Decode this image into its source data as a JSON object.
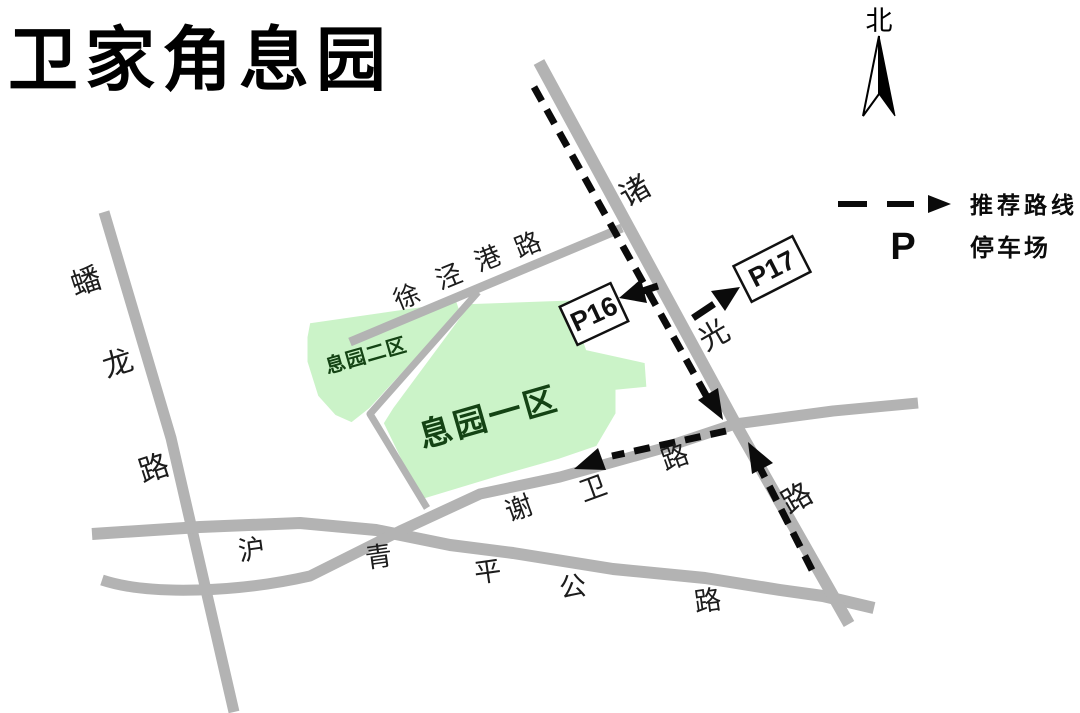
{
  "title": "卫家角息园",
  "compass": {
    "label": "北"
  },
  "legend": {
    "route_label": "推荐路线",
    "parking_symbol": "P",
    "parking_label": "停车场"
  },
  "areas": {
    "zone2": {
      "label": "息园二区"
    },
    "zone1": {
      "label": "息园一区"
    }
  },
  "parking": {
    "p16": {
      "label": "P16"
    },
    "p17": {
      "label": "P17"
    }
  },
  "roads": {
    "panlonglu": {
      "name": "蟠龙路",
      "chars": [
        "蟠",
        "龙",
        "路"
      ]
    },
    "xujingganglu": {
      "name": "徐泾港路",
      "chars": [
        "徐",
        "泾",
        "港",
        "路"
      ]
    },
    "zhuguanglu": {
      "name": "诸光路",
      "chars": [
        "诸",
        "光",
        "路"
      ]
    },
    "xieweilu": {
      "name": "谢卫路",
      "chars": [
        "谢",
        "卫",
        "路"
      ]
    },
    "huqingpinggonglu": {
      "name": "沪青平公路",
      "chars": [
        "沪",
        "青",
        "平",
        "公",
        "路"
      ]
    }
  },
  "colors": {
    "road_gray": "#b3b3b3",
    "area_green": "#cbf3c8",
    "area_label_green": "#144314",
    "route_black": "#0b0b0b"
  }
}
